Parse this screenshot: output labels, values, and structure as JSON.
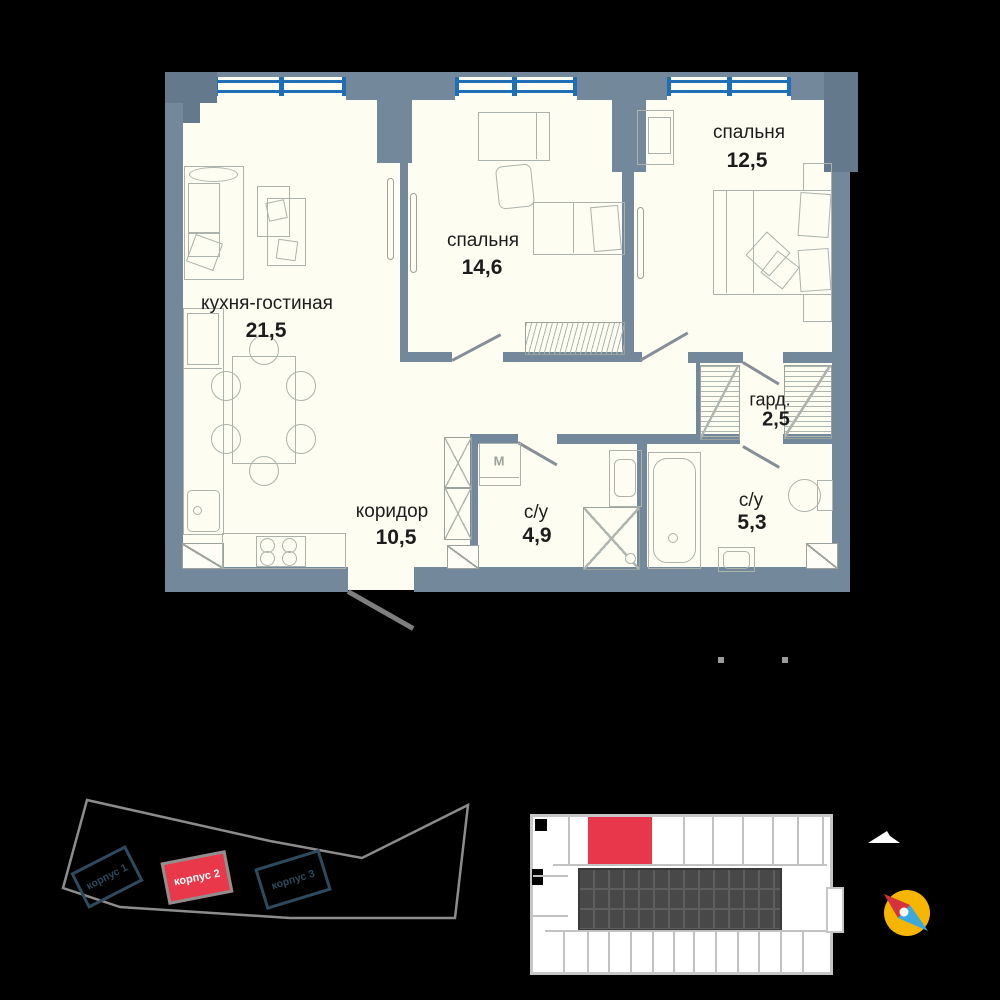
{
  "background": "#000000",
  "floor_plan": {
    "wall_color": "#74889B",
    "corner_wall_color": "#64798C",
    "window_color": "#1E6FB5",
    "floor_color": "#FDFDF1",
    "furniture_line_color": "#ACB3AC",
    "text_color": "#1C1C1C",
    "rooms": [
      {
        "id": "kitchen-living",
        "name": "кухня-гостиная",
        "area": "21,5"
      },
      {
        "id": "bedroom-1",
        "name": "спальня",
        "area": "14,6"
      },
      {
        "id": "bedroom-2",
        "name": "спальня",
        "area": "12,5"
      },
      {
        "id": "corridor",
        "name": "коридор",
        "area": "10,5"
      },
      {
        "id": "bathroom-1",
        "name": "с/у",
        "area": "4,9"
      },
      {
        "id": "bathroom-2",
        "name": "с/у",
        "area": "5,3"
      },
      {
        "id": "wardrobe-room",
        "name": "гард.",
        "area": "2,5"
      }
    ],
    "washer_label": "M"
  },
  "site_plan": {
    "outline_color": "#8C8C8C",
    "building_outline_color": "#2E4A5C",
    "highlight_color": "#E8384A",
    "buildings": [
      {
        "label": "корпус 1",
        "highlighted": false
      },
      {
        "label": "корпус 2",
        "highlighted": true
      },
      {
        "label": "корпус 3",
        "highlighted": false
      }
    ]
  },
  "key_plan": {
    "outline_color": "#C6C6C6",
    "core_color": "#484848",
    "highlight_color": "#E8374A"
  },
  "compass": {
    "icon": "compass-icon",
    "circle_color": "#F5B500",
    "north_color": "#D6323C",
    "south_color": "#3BA9DD"
  }
}
